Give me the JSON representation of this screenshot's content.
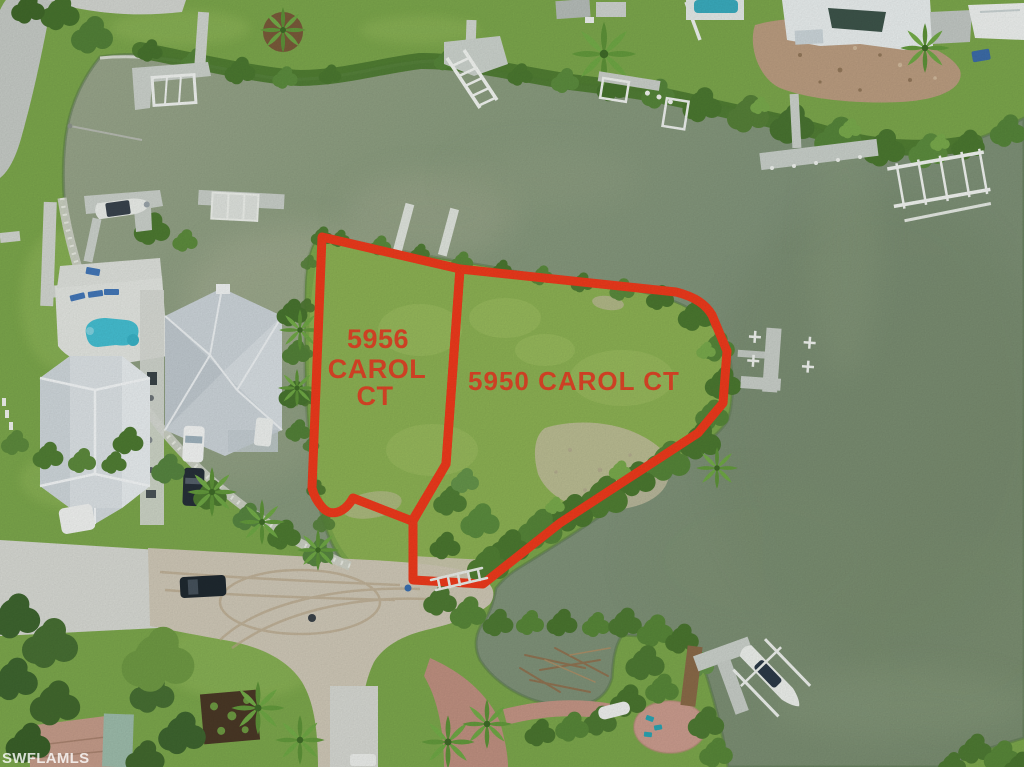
{
  "photo": {
    "watermark": "SWFLAMLS"
  },
  "lots": {
    "left": {
      "address_line1": "5956",
      "address_line2": "CAROL",
      "address_line3": "CT"
    },
    "right": {
      "address": "5950 CAROL CT"
    }
  },
  "colors": {
    "lot_outline": "#ee3a1c",
    "lot_label": "#dd4527",
    "watermark_text": "#ffffff"
  }
}
